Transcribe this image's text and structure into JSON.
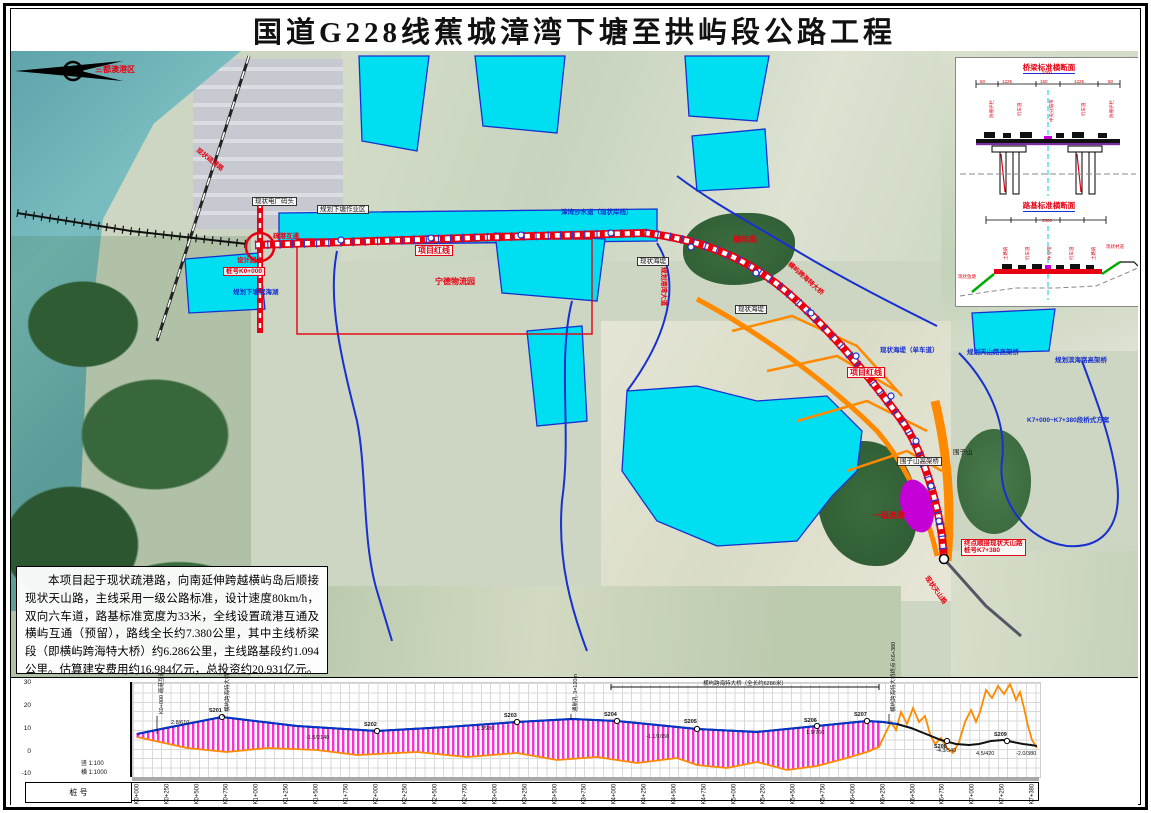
{
  "title": "国道G228线蕉城漳湾下塘至拱屿段公路工程",
  "colors": {
    "route_red": "#e60012",
    "water_cyan": "#00dff2",
    "boundary_blue": "#1730cf",
    "planned_orange": "#ff8a00",
    "bridge_hatch_pink": "#ff2fd2",
    "design_line_blue": "#0033cc",
    "ground_line_orange": "#ff8a00",
    "fishport_purple": "#c400d6"
  },
  "description": {
    "text": "本项目起于现状疏港路，向南延伸跨越横屿岛后顺接现状天山路，主线采用一级公路标准，设计速度80km/h，双向六车道，路基标准宽度为33米，全线设置疏港互通及横屿互通（预留），路线全长约7.380公里，其中主线桥梁段（即横屿跨海特大桥）约6.286公里，主线路基段约1.094公里。估算建安费用约16.984亿元，总投资约20.931亿元。"
  },
  "map": {
    "labels": [
      {
        "t": "三都澳港区",
        "x": 84,
        "y": 14,
        "cls": "red"
      },
      {
        "t": "现状疏港路",
        "x": 188,
        "y": 96,
        "cls": "red sm",
        "rot": 38
      },
      {
        "t": "现状电厂码头",
        "x": 241,
        "y": 146,
        "cls": "box sm"
      },
      {
        "t": "规划下塘作业区",
        "x": 306,
        "y": 154,
        "cls": "box sm"
      },
      {
        "t": "疏港互通",
        "x": 262,
        "y": 182,
        "cls": "red sm"
      },
      {
        "t": "设计起点",
        "x": 226,
        "y": 206,
        "cls": "red sm"
      },
      {
        "t": "桩号K0+000",
        "x": 212,
        "y": 216,
        "cls": "redbox sm"
      },
      {
        "t": "规划下塘滨海湖",
        "x": 222,
        "y": 238,
        "cls": "blue sm"
      },
      {
        "t": "项目红线",
        "x": 404,
        "y": 194,
        "cls": "redbox"
      },
      {
        "t": "宁德物流园",
        "x": 424,
        "y": 226,
        "cls": "red"
      },
      {
        "t": "漳湾沙水道（现状岸线）",
        "x": 550,
        "y": 158,
        "cls": "blue sm"
      },
      {
        "t": "现状海堤",
        "x": 626,
        "y": 206,
        "cls": "box sm"
      },
      {
        "t": "横屿岛",
        "x": 722,
        "y": 184,
        "cls": "red"
      },
      {
        "t": "现状海堤",
        "x": 724,
        "y": 254,
        "cls": "box sm"
      },
      {
        "t": "规划港湾大道",
        "x": 656,
        "y": 216,
        "cls": "red sm",
        "rot": 90
      },
      {
        "t": "横屿跨海特大桥",
        "x": 780,
        "y": 210,
        "cls": "red sm",
        "rot": 42
      },
      {
        "t": "项目红线",
        "x": 836,
        "y": 316,
        "cls": "redbox"
      },
      {
        "t": "现状海堤（单车道）",
        "x": 869,
        "y": 296,
        "cls": "blue sm"
      },
      {
        "t": "规划天山路高架桥",
        "x": 956,
        "y": 298,
        "cls": "blue sm"
      },
      {
        "t": "一般农田区",
        "x": 1022,
        "y": 198,
        "cls": "blue sm"
      },
      {
        "t": "规划滨海路高架桥",
        "x": 1044,
        "y": 306,
        "cls": "blue sm"
      },
      {
        "t": "K7+000~K7+380段桥式方案",
        "x": 1016,
        "y": 366,
        "cls": "blue sm"
      },
      {
        "t": "围子山",
        "x": 942,
        "y": 398,
        "cls": "black sm"
      },
      {
        "t": "围子山高架桥",
        "x": 886,
        "y": 406,
        "cls": "box sm"
      },
      {
        "t": "一级渔港",
        "x": 862,
        "y": 460,
        "cls": "red"
      },
      {
        "t": "终点顺接现状天山路\n桩号K7+380",
        "x": 950,
        "y": 488,
        "cls": "redbox sm"
      },
      {
        "t": "现状天山路",
        "x": 918,
        "y": 524,
        "cls": "red sm",
        "rot": 55
      }
    ]
  },
  "inset": {
    "bridge_section_title": "桥梁标准横断面",
    "subgrade_section_title": "路基标准横断面",
    "bridge_labels": [
      {
        "t": "3300",
        "x": 86,
        "y": 12,
        "cls": "dim"
      },
      {
        "t": "50",
        "x": 24,
        "y": 21,
        "cls": "dim"
      },
      {
        "t": "1225",
        "x": 46,
        "y": 21,
        "cls": "dim"
      },
      {
        "t": "150",
        "x": 84,
        "y": 21,
        "cls": "dim"
      },
      {
        "t": "1225",
        "x": 118,
        "y": 21,
        "cls": "dim"
      },
      {
        "t": "50",
        "x": 152,
        "y": 21,
        "cls": "dim"
      },
      {
        "t": "防撞护栏",
        "x": 33,
        "y": 60,
        "rot": -90
      },
      {
        "t": "行车道",
        "x": 61,
        "y": 58,
        "rot": -90
      },
      {
        "t": "中央分隔带",
        "x": 93,
        "y": 64,
        "rot": -90
      },
      {
        "t": "行车道",
        "x": 125,
        "y": 58,
        "rot": -90
      },
      {
        "t": "防撞护栏",
        "x": 153,
        "y": 60,
        "rot": -90
      }
    ],
    "subgrade_labels": [
      {
        "t": "3300",
        "x": 86,
        "y": 10,
        "cls": "dim"
      },
      {
        "t": "土路肩",
        "x": 47,
        "y": 52,
        "rot": -90
      },
      {
        "t": "行车道",
        "x": 69,
        "y": 52,
        "rot": -90
      },
      {
        "t": "中分带",
        "x": 91,
        "y": 52,
        "rot": -90
      },
      {
        "t": "行车道",
        "x": 113,
        "y": 52,
        "rot": -90
      },
      {
        "t": "土路肩",
        "x": 135,
        "y": 52,
        "rot": -90
      },
      {
        "t": "现状鱼塘",
        "x": 2,
        "y": 66
      },
      {
        "t": "现状村道",
        "x": 150,
        "y": 36
      }
    ]
  },
  "profile": {
    "y_ticks": [
      {
        "t": "30",
        "x": 0,
        "y": 1
      },
      {
        "t": "20",
        "x": 0,
        "y": 24
      },
      {
        "t": "10",
        "x": 0,
        "y": 47
      },
      {
        "t": "0",
        "x": 0,
        "y": 70
      },
      {
        "t": "-10",
        "x": 0,
        "y": 92
      }
    ],
    "scale_v": "竖 1:100",
    "scale_h": "横 1:1000",
    "row_header": "桩  号",
    "bridge_note": "横屿跨海特大桥（全长约6286米）",
    "chainages": [
      "K0+000",
      "K0+250",
      "K0+500",
      "K0+750",
      "K1+000",
      "K1+250",
      "K1+500",
      "K1+750",
      "K2+000",
      "K2+250",
      "K2+500",
      "K2+750",
      "K3+000",
      "K3+250",
      "K3+500",
      "K3+750",
      "K4+000",
      "K4+250",
      "K4+500",
      "K4+750",
      "K5+000",
      "K5+250",
      "K5+500",
      "K5+750",
      "K6+000",
      "K6+250",
      "K6+500",
      "K6+750",
      "K7+000",
      "K7+250",
      "K7+380"
    ],
    "curve_markers": [
      {
        "t": "S201",
        "x": 198,
        "y": 30,
        "cls": "curve"
      },
      {
        "t": "S202",
        "x": 353,
        "y": 44,
        "cls": "curve"
      },
      {
        "t": "S203",
        "x": 493,
        "y": 35,
        "cls": "curve"
      },
      {
        "t": "S204",
        "x": 593,
        "y": 34,
        "cls": "curve"
      },
      {
        "t": "S205",
        "x": 673,
        "y": 41,
        "cls": "curve"
      },
      {
        "t": "S206",
        "x": 793,
        "y": 40,
        "cls": "curve"
      },
      {
        "t": "S207",
        "x": 843,
        "y": 34,
        "cls": "curve"
      },
      {
        "t": "S208",
        "x": 923,
        "y": 66,
        "cls": "curve"
      },
      {
        "t": "S209",
        "x": 983,
        "y": 54,
        "cls": "curve"
      }
    ],
    "grade_labels": [
      {
        "t": "2.8/610",
        "x": 160,
        "y": 42
      },
      {
        "t": "-1.5/2140",
        "x": 295,
        "y": 57
      },
      {
        "t": "1.3/980",
        "x": 465,
        "y": 48
      },
      {
        "t": "-1.1/1650",
        "x": 635,
        "y": 56
      },
      {
        "t": "1.9/760",
        "x": 795,
        "y": 52
      },
      {
        "t": "-4.3/540",
        "x": 925,
        "y": 70
      },
      {
        "t": "4.5/420",
        "x": 965,
        "y": 73
      },
      {
        "t": "-2.0/380",
        "x": 1005,
        "y": 73
      }
    ],
    "flag_labels": [
      {
        "t": "K0+000 疏港互通",
        "x": 146,
        "y": 36,
        "rot": -90
      },
      {
        "t": "横屿跨海特大桥起点 K0+094",
        "x": 212,
        "y": 34,
        "rot": -90
      },
      {
        "t": "通航孔 3×120m",
        "x": 560,
        "y": 34,
        "rot": -90
      },
      {
        "t": "横屿跨海特大桥终点 K6+380",
        "x": 878,
        "y": 34,
        "rot": -90
      }
    ]
  },
  "chart_data": {
    "type": "line",
    "title": "路线纵断面图",
    "xlabel": "桩号",
    "ylabel": "高程(m)",
    "x_range": [
      "K0+000",
      "K7+380"
    ],
    "ylim": [
      -10,
      30
    ],
    "series": [
      {
        "name": "设计线",
        "x_km": [
          0.0,
          0.6,
          1.5,
          2.5,
          3.5,
          4.2,
          5.0,
          5.6,
          6.0,
          6.4,
          6.8,
          7.0,
          7.38
        ],
        "elev_m": [
          8,
          12,
          9,
          10,
          11,
          12,
          9,
          11,
          8,
          6,
          7,
          7,
          6
        ]
      },
      {
        "name": "地面线",
        "x_km": [
          0.0,
          1.0,
          2.0,
          3.0,
          4.0,
          5.0,
          5.8,
          6.1,
          6.3,
          6.5,
          6.8,
          7.0,
          7.1,
          7.38
        ],
        "elev_m": [
          7,
          4,
          5,
          3,
          2,
          4,
          6,
          18,
          3,
          22,
          28,
          24,
          12,
          5
        ]
      }
    ],
    "bridge_extent_km": [
      0.094,
      6.38
    ],
    "legend_position": "none",
    "grid": true
  }
}
